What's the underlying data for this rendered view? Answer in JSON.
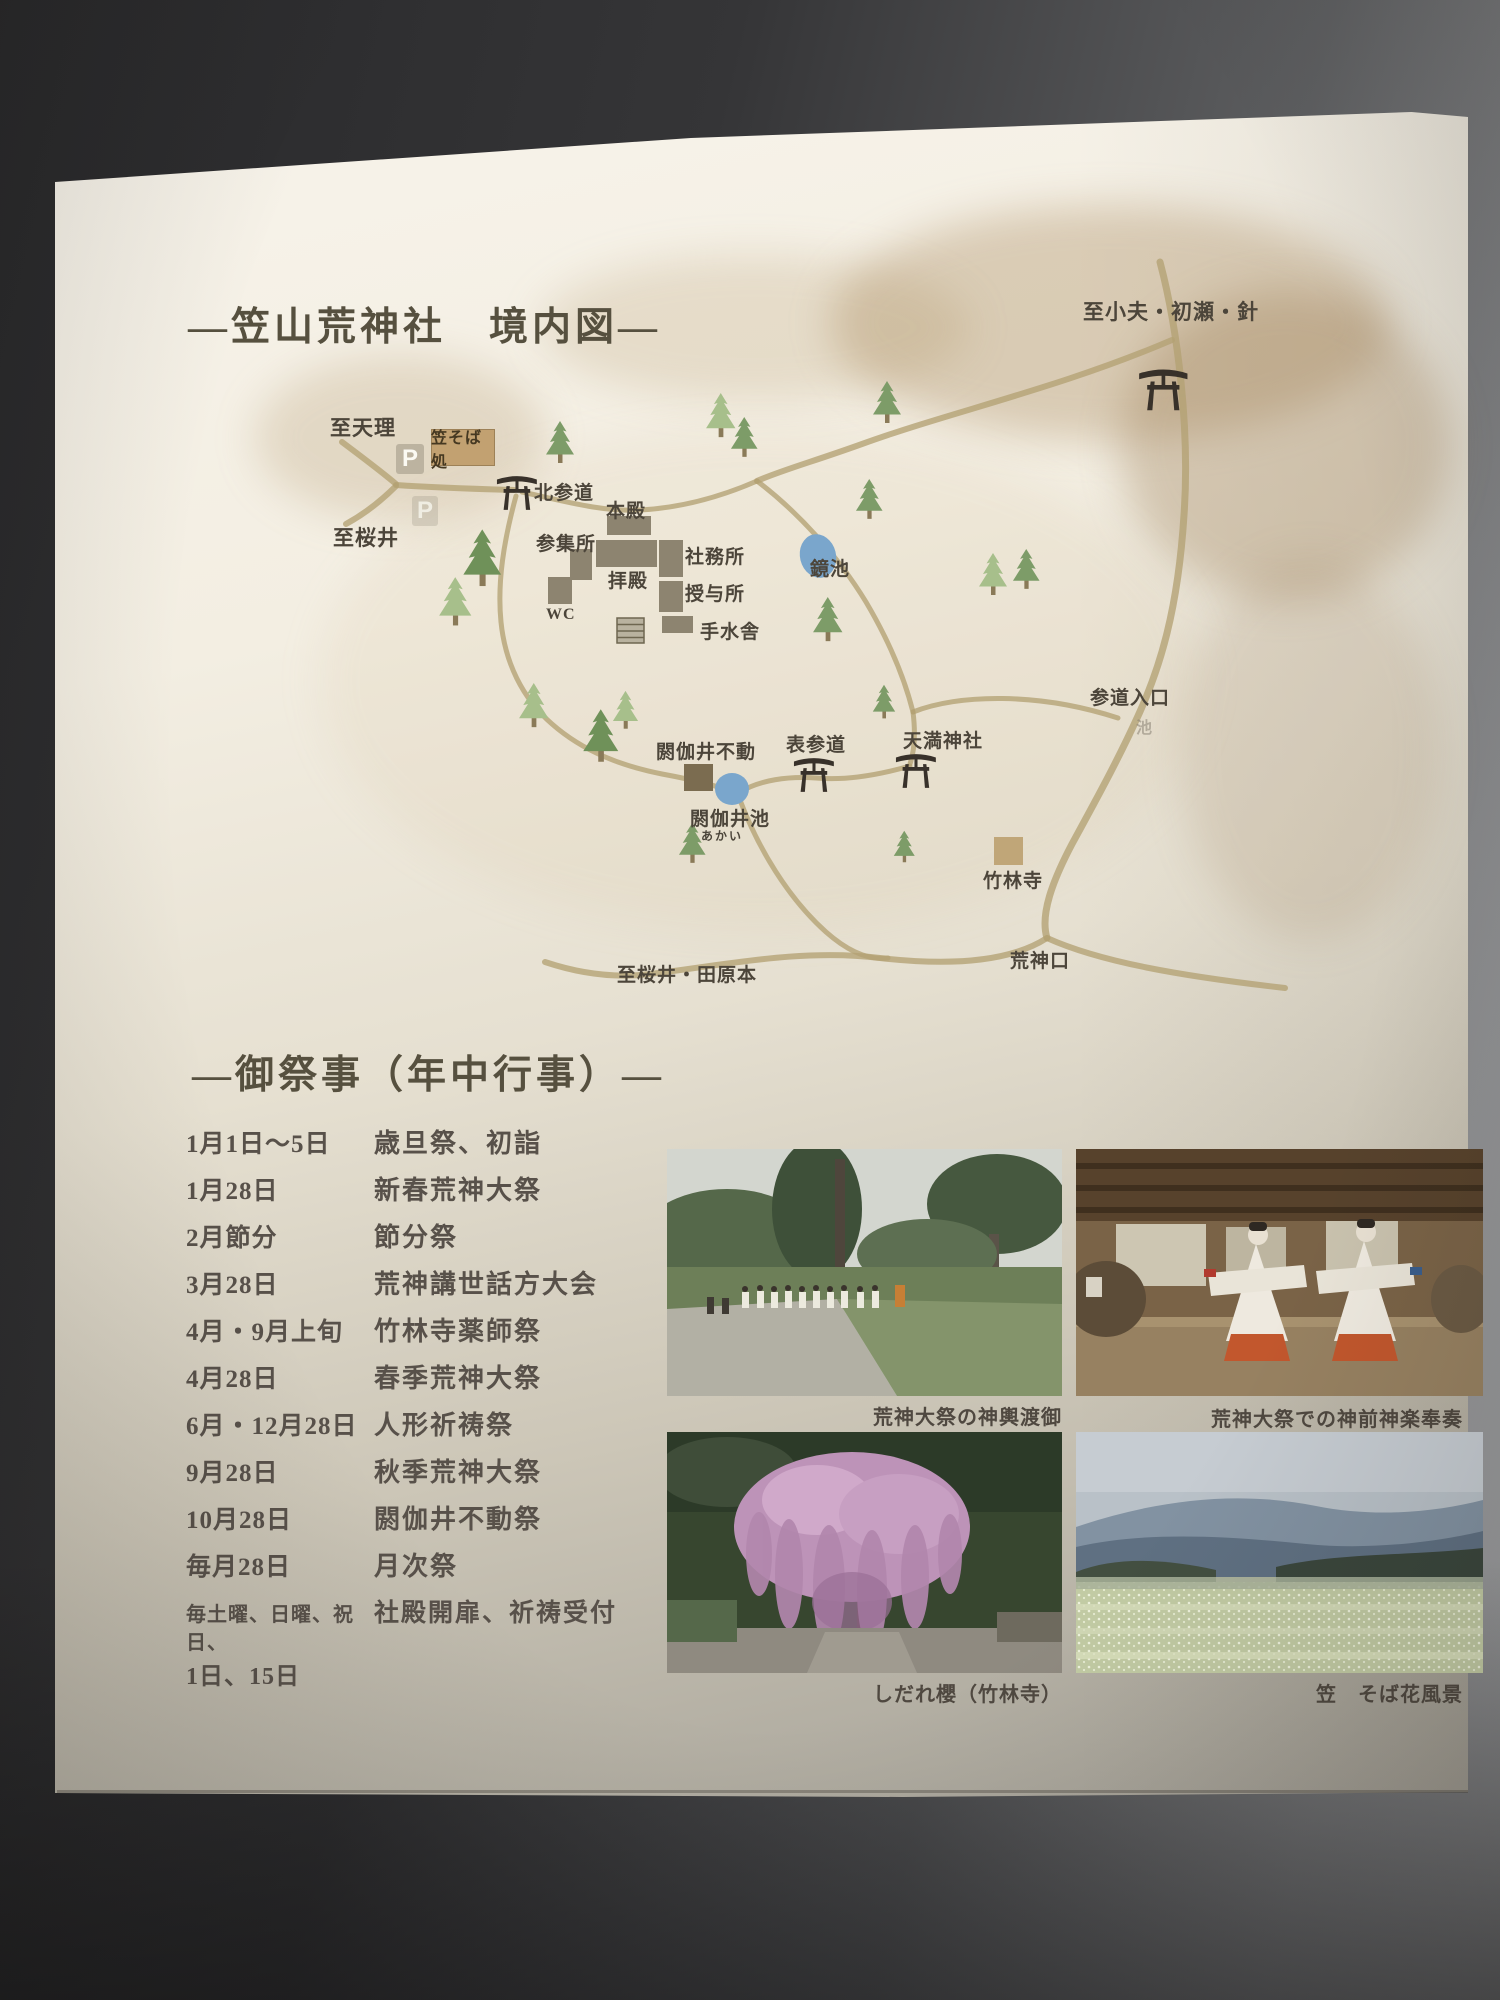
{
  "palette": {
    "paper": "#f3eee3",
    "background": "#3a3a3c",
    "road_tan": "#b3a173",
    "tree_dark": "#7d9c68",
    "tree_light": "#a7bf8b",
    "pond_blue": "#7aa6cc",
    "building_gray": "#8d8470",
    "tan_box": "#c0a678",
    "ink": "#4c453a"
  },
  "map_section": {
    "title": "—笠山荒神社　境内図—",
    "parking_label": "P",
    "soba_shop_label": "笠そば処",
    "labels": [
      {
        "id": "to-obu-hase-hari",
        "text": "至小夫・初瀬・針"
      },
      {
        "id": "to-tenri",
        "text": "至天理"
      },
      {
        "id": "kita-sando",
        "text": "北参道"
      },
      {
        "id": "to-sakurai",
        "text": "至桜井"
      },
      {
        "id": "honden",
        "text": "本殿"
      },
      {
        "id": "sanshujo",
        "text": "参集所"
      },
      {
        "id": "haiden",
        "text": "拝殿"
      },
      {
        "id": "shamusho",
        "text": "社務所"
      },
      {
        "id": "juyosho",
        "text": "授与所"
      },
      {
        "id": "wc",
        "text": "WC"
      },
      {
        "id": "temizusha",
        "text": "手水舎"
      },
      {
        "id": "kagami-ike",
        "text": "鏡池"
      },
      {
        "id": "akai-fudo",
        "text": "閼伽井不動"
      },
      {
        "id": "akai-ike",
        "text": "閼伽井池"
      },
      {
        "id": "akai-furigana",
        "text": "あかい"
      },
      {
        "id": "omote-sando",
        "text": "表参道"
      },
      {
        "id": "tenman-jinja",
        "text": "天満神社"
      },
      {
        "id": "sando-iriguchi",
        "text": "参道入口"
      },
      {
        "id": "ike-faint",
        "text": "池"
      },
      {
        "id": "chikurinji",
        "text": "竹林寺"
      },
      {
        "id": "kojin-guchi",
        "text": "荒神口"
      },
      {
        "id": "to-sakurai-tawaramoto",
        "text": "至桜井・田原本"
      }
    ]
  },
  "festival_section": {
    "title": "—御祭事（年中行事）—",
    "rows": [
      {
        "date": "1月1日～5日",
        "name": "歳旦祭、初詣"
      },
      {
        "date": "1月28日",
        "name": "新春荒神大祭"
      },
      {
        "date": "2月節分",
        "name": "節分祭"
      },
      {
        "date": "3月28日",
        "name": "荒神講世話方大会"
      },
      {
        "date": "4月・9月上旬",
        "name": "竹林寺薬師祭"
      },
      {
        "date": "4月28日",
        "name": "春季荒神大祭"
      },
      {
        "date": "6月・12月28日",
        "name": "人形祈祷祭"
      },
      {
        "date": "9月28日",
        "name": "秋季荒神大祭"
      },
      {
        "date": "10月28日",
        "name": "閼伽井不動祭"
      },
      {
        "date": "毎月28日",
        "name": "月次祭"
      },
      {
        "date": "毎土曜、日曜、祝日、",
        "date2": "1日、15日",
        "name": "社殿開扉、祈祷受付"
      }
    ]
  },
  "photos": [
    {
      "caption": "荒神大祭の神輿渡御"
    },
    {
      "caption": "荒神大祭での神前神楽奉奏"
    },
    {
      "caption": "しだれ櫻（竹林寺）"
    },
    {
      "caption": "笠　そば花風景"
    }
  ]
}
